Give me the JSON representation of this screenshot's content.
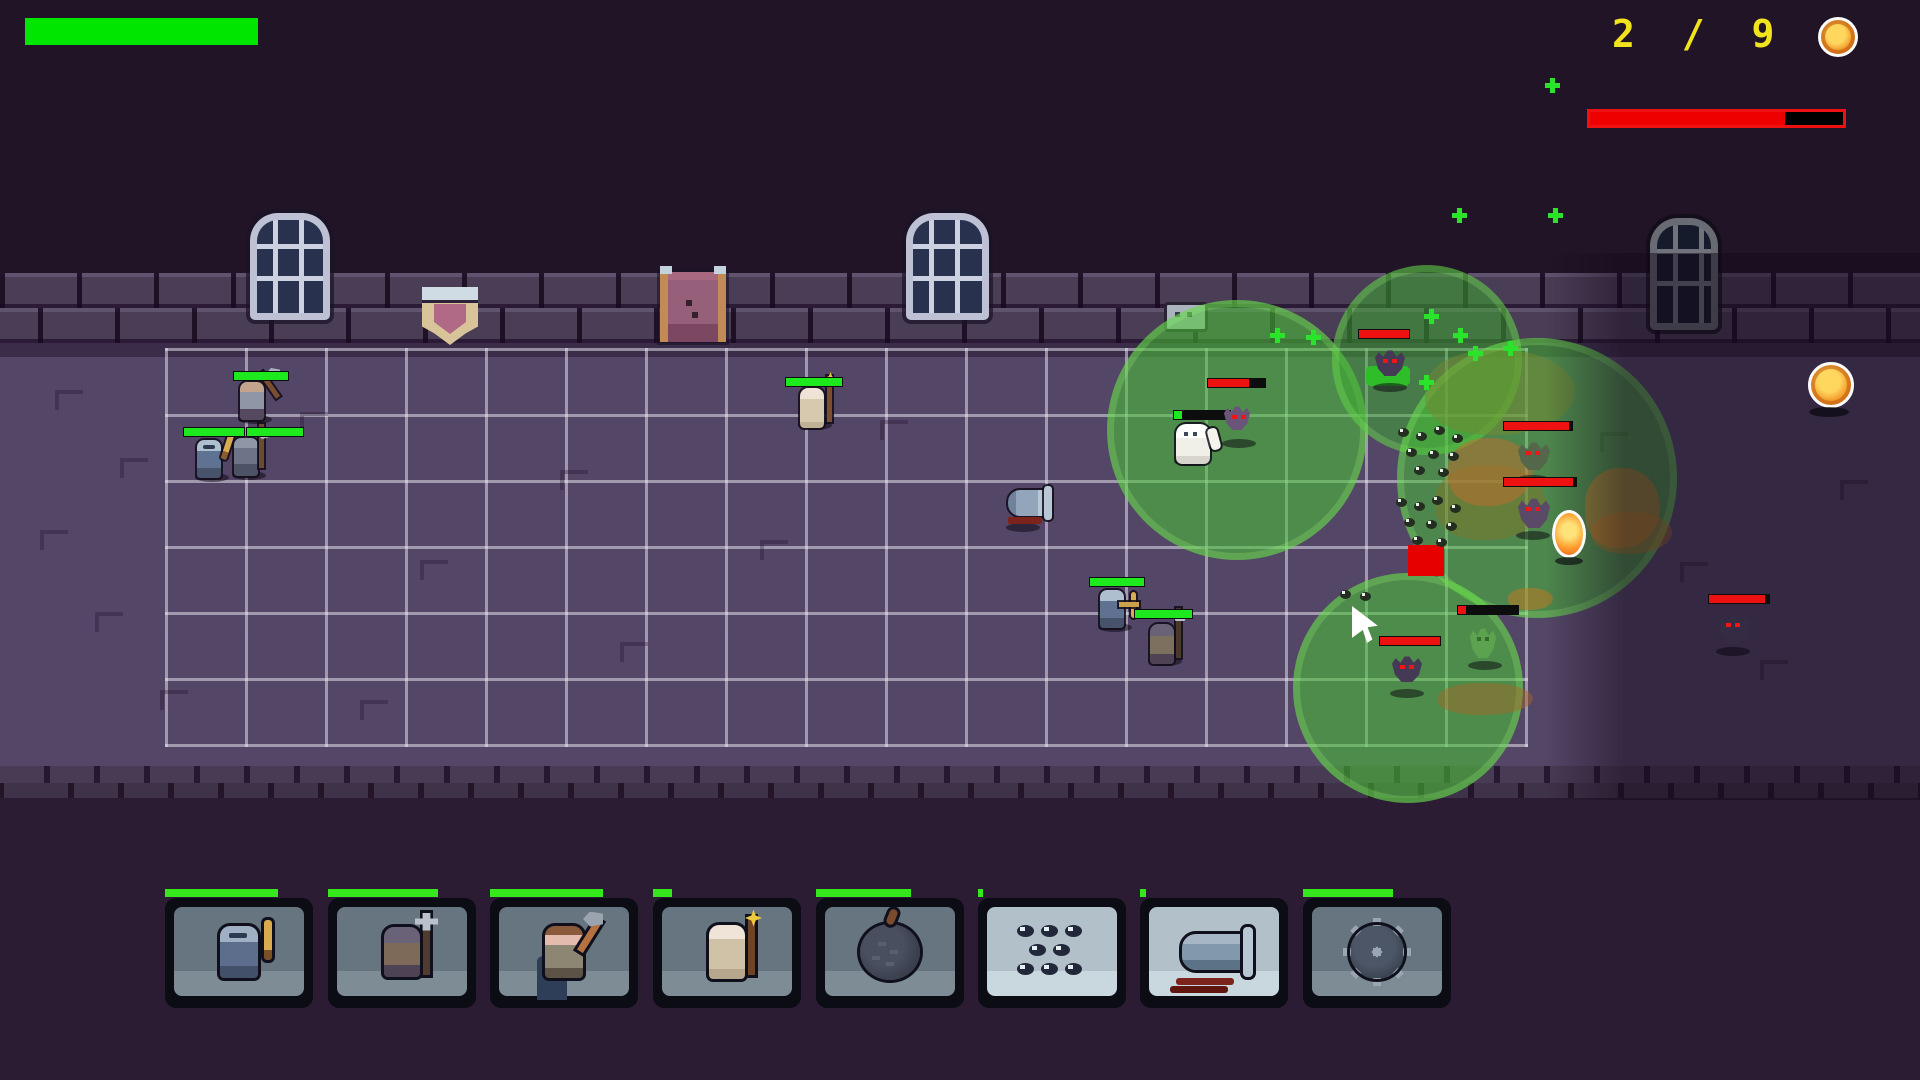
{
  "hud": {
    "health_bar": {
      "x": 25,
      "y": 18,
      "w": 233,
      "h": 27,
      "color": "#00e600"
    },
    "wave_counter": {
      "text": "2 / 9",
      "x": 1612,
      "y": 12,
      "color": "#f2e41c"
    },
    "coin_icon": {
      "x": 1818,
      "y": 17,
      "size": 34
    },
    "boss_bar": {
      "x": 1587,
      "y": 109,
      "w": 253,
      "h": 13,
      "fill_pct": 77
    }
  },
  "toolbar": {
    "y": 898,
    "card_w": 148,
    "card_h": 110,
    "cooldown_y": 889,
    "cooldown_h": 8,
    "cooldown_color": "#35e81c",
    "cards": [
      {
        "name": "knight-sword",
        "x": 165,
        "panel": "dark",
        "cooldown_w": 113
      },
      {
        "name": "crossbow-pikeman",
        "x": 328,
        "panel": "dark",
        "cooldown_w": 110
      },
      {
        "name": "axe-warrior",
        "x": 490,
        "panel": "dark",
        "cooldown_w": 113
      },
      {
        "name": "mage",
        "x": 653,
        "panel": "dark",
        "cooldown_w": 19
      },
      {
        "name": "bomb",
        "x": 816,
        "panel": "dark",
        "cooldown_w": 95
      },
      {
        "name": "bug-swarm",
        "x": 978,
        "panel": "light",
        "cooldown_w": 5
      },
      {
        "name": "cannon",
        "x": 1140,
        "panel": "light",
        "cooldown_w": 6
      },
      {
        "name": "spike-mine",
        "x": 1303,
        "panel": "dark",
        "cooldown_w": 90
      }
    ]
  },
  "wall": {
    "windows": [
      {
        "x": 250,
        "y": 213,
        "w": 80,
        "h": 107,
        "dark": false
      },
      {
        "x": 906,
        "y": 213,
        "w": 83,
        "h": 107,
        "dark": false
      },
      {
        "x": 1650,
        "y": 218,
        "w": 68,
        "h": 112,
        "dark": true
      }
    ],
    "door": {
      "x": 660,
      "y": 272,
      "w": 50,
      "h": 70
    },
    "banner": {
      "x": 422,
      "y": 287,
      "w": 56,
      "h": 58
    },
    "crest": {
      "x": 1164,
      "y": 302,
      "w": 38,
      "h": 24
    }
  },
  "field": {
    "grid": {
      "x": 165,
      "y": 348,
      "cols": 17,
      "rows": 6,
      "cell_w": 80,
      "cell_h": 66,
      "line_color": "rgba(238,238,248,0.5)"
    },
    "aoe_circles": [
      {
        "x": 1107,
        "y": 300,
        "d": 260,
        "color": "rgba(72,199,52,0.55)"
      },
      {
        "x": 1332,
        "y": 265,
        "d": 190,
        "color": "rgba(60,175,46,0.5)"
      },
      {
        "x": 1397,
        "y": 338,
        "d": 280,
        "color": "rgba(72,199,52,0.5)"
      },
      {
        "x": 1293,
        "y": 573,
        "d": 230,
        "color": "rgba(72,199,52,0.55)"
      }
    ],
    "gas_blobs": [
      {
        "x": 1425,
        "y": 350,
        "w": 150,
        "h": 85,
        "color": "rgba(116,138,48,0.5)"
      },
      {
        "x": 1435,
        "y": 465,
        "w": 110,
        "h": 75,
        "color": "rgba(128,118,42,0.5)"
      },
      {
        "x": 1448,
        "y": 438,
        "w": 85,
        "h": 68,
        "color": "rgba(193,108,44,0.5)"
      },
      {
        "x": 1585,
        "y": 468,
        "w": 75,
        "h": 80,
        "color": "rgba(205,120,40,0.5)"
      },
      {
        "x": 1592,
        "y": 512,
        "w": 80,
        "h": 42,
        "color": "rgba(188,112,38,0.45)"
      },
      {
        "x": 1508,
        "y": 588,
        "w": 45,
        "h": 22,
        "color": "rgba(200,120,32,0.5)"
      },
      {
        "x": 1438,
        "y": 683,
        "w": 95,
        "h": 32,
        "color": "rgba(170,100,36,0.45)"
      }
    ],
    "red_marker": {
      "x": 1408,
      "y": 545,
      "w": 36,
      "h": 31,
      "color": "#e60000"
    },
    "green_patch": {
      "x": 1366,
      "y": 366,
      "w": 44,
      "h": 20,
      "color": "#2fbe2a"
    },
    "sparkle_plusses": [
      [
        1545,
        78
      ],
      [
        1452,
        208
      ],
      [
        1548,
        208
      ],
      [
        1424,
        309
      ],
      [
        1270,
        328
      ],
      [
        1306,
        330
      ],
      [
        1453,
        328
      ],
      [
        1503,
        341
      ],
      [
        1468,
        346
      ],
      [
        1419,
        375
      ]
    ],
    "swarm_clusters": [
      {
        "x": 1398,
        "y": 428,
        "size": "big"
      },
      {
        "x": 1396,
        "y": 498,
        "size": "big"
      },
      {
        "x": 1340,
        "y": 590,
        "size": "small"
      }
    ],
    "floor_marks": [
      [
        55,
        390
      ],
      [
        120,
        458
      ],
      [
        40,
        530
      ],
      [
        95,
        612
      ],
      [
        160,
        690
      ],
      [
        300,
        412
      ],
      [
        420,
        560
      ],
      [
        360,
        700
      ],
      [
        560,
        470
      ],
      [
        620,
        642
      ],
      [
        760,
        540
      ],
      [
        880,
        420
      ],
      [
        1600,
        432
      ],
      [
        1680,
        562
      ],
      [
        1760,
        660
      ],
      [
        1840,
        480
      ]
    ],
    "pickups": [
      {
        "type": "coin",
        "x": 1808,
        "y": 362
      },
      {
        "type": "flame-orb",
        "x": 1552,
        "y": 510
      }
    ],
    "cursor": {
      "x": 1352,
      "y": 606
    },
    "player_units": [
      {
        "type": "axe-knight",
        "x": 240,
        "y": 382,
        "bar": {
          "x": 233,
          "y": 371,
          "w": 54,
          "pct": 100
        }
      },
      {
        "type": "sword-knight",
        "x": 197,
        "y": 440,
        "bar": {
          "x": 183,
          "y": 427,
          "w": 60,
          "pct": 100
        }
      },
      {
        "type": "halberd-knight",
        "x": 234,
        "y": 438,
        "bar": {
          "x": 246,
          "y": 427,
          "w": 56,
          "pct": 100
        }
      },
      {
        "type": "mage",
        "x": 800,
        "y": 388,
        "bar": {
          "x": 785,
          "y": 377,
          "w": 56,
          "pct": 100
        }
      },
      {
        "type": "crossbow-knight",
        "x": 1100,
        "y": 590,
        "bar": {
          "x": 1089,
          "y": 577,
          "w": 54,
          "pct": 100
        }
      },
      {
        "type": "hood-archer",
        "x": 1150,
        "y": 624,
        "bar": {
          "x": 1134,
          "y": 609,
          "w": 57,
          "pct": 100
        }
      },
      {
        "type": "golem",
        "x": 1176,
        "y": 424,
        "bar": {
          "x": 1173,
          "y": 410,
          "w": 56,
          "pct": 14
        }
      },
      {
        "type": "cannon-unit",
        "x": 1008,
        "y": 490
      }
    ],
    "enemies": [
      {
        "type": "bat",
        "x": 1375,
        "y": 350,
        "bar": {
          "x": 1358,
          "y": 329,
          "w": 50,
          "pct": 100
        }
      },
      {
        "type": "purple-bat",
        "x": 1224,
        "y": 406,
        "bar": {
          "x": 1207,
          "y": 378,
          "w": 57,
          "pct": 72
        }
      },
      {
        "type": "green-spider",
        "x": 1518,
        "y": 442,
        "bar": {
          "x": 1503,
          "y": 421,
          "w": 68,
          "pct": 96
        }
      },
      {
        "type": "purple-spider",
        "x": 1518,
        "y": 498,
        "bar": {
          "x": 1503,
          "y": 477,
          "w": 72,
          "pct": 96
        }
      },
      {
        "type": "bat",
        "x": 1392,
        "y": 656,
        "bar": {
          "x": 1379,
          "y": 636,
          "w": 60,
          "pct": 100
        }
      },
      {
        "type": "shadow-spider",
        "x": 1718,
        "y": 614,
        "bar": {
          "x": 1708,
          "y": 594,
          "w": 60,
          "pct": 93
        }
      },
      {
        "type": "ghost",
        "x": 1470,
        "y": 628,
        "bar": {
          "x": 1457,
          "y": 605,
          "w": 60,
          "pct": 14
        }
      }
    ],
    "bar_colors": {
      "player": "#1ee81e",
      "enemy": "#ee1111"
    }
  }
}
